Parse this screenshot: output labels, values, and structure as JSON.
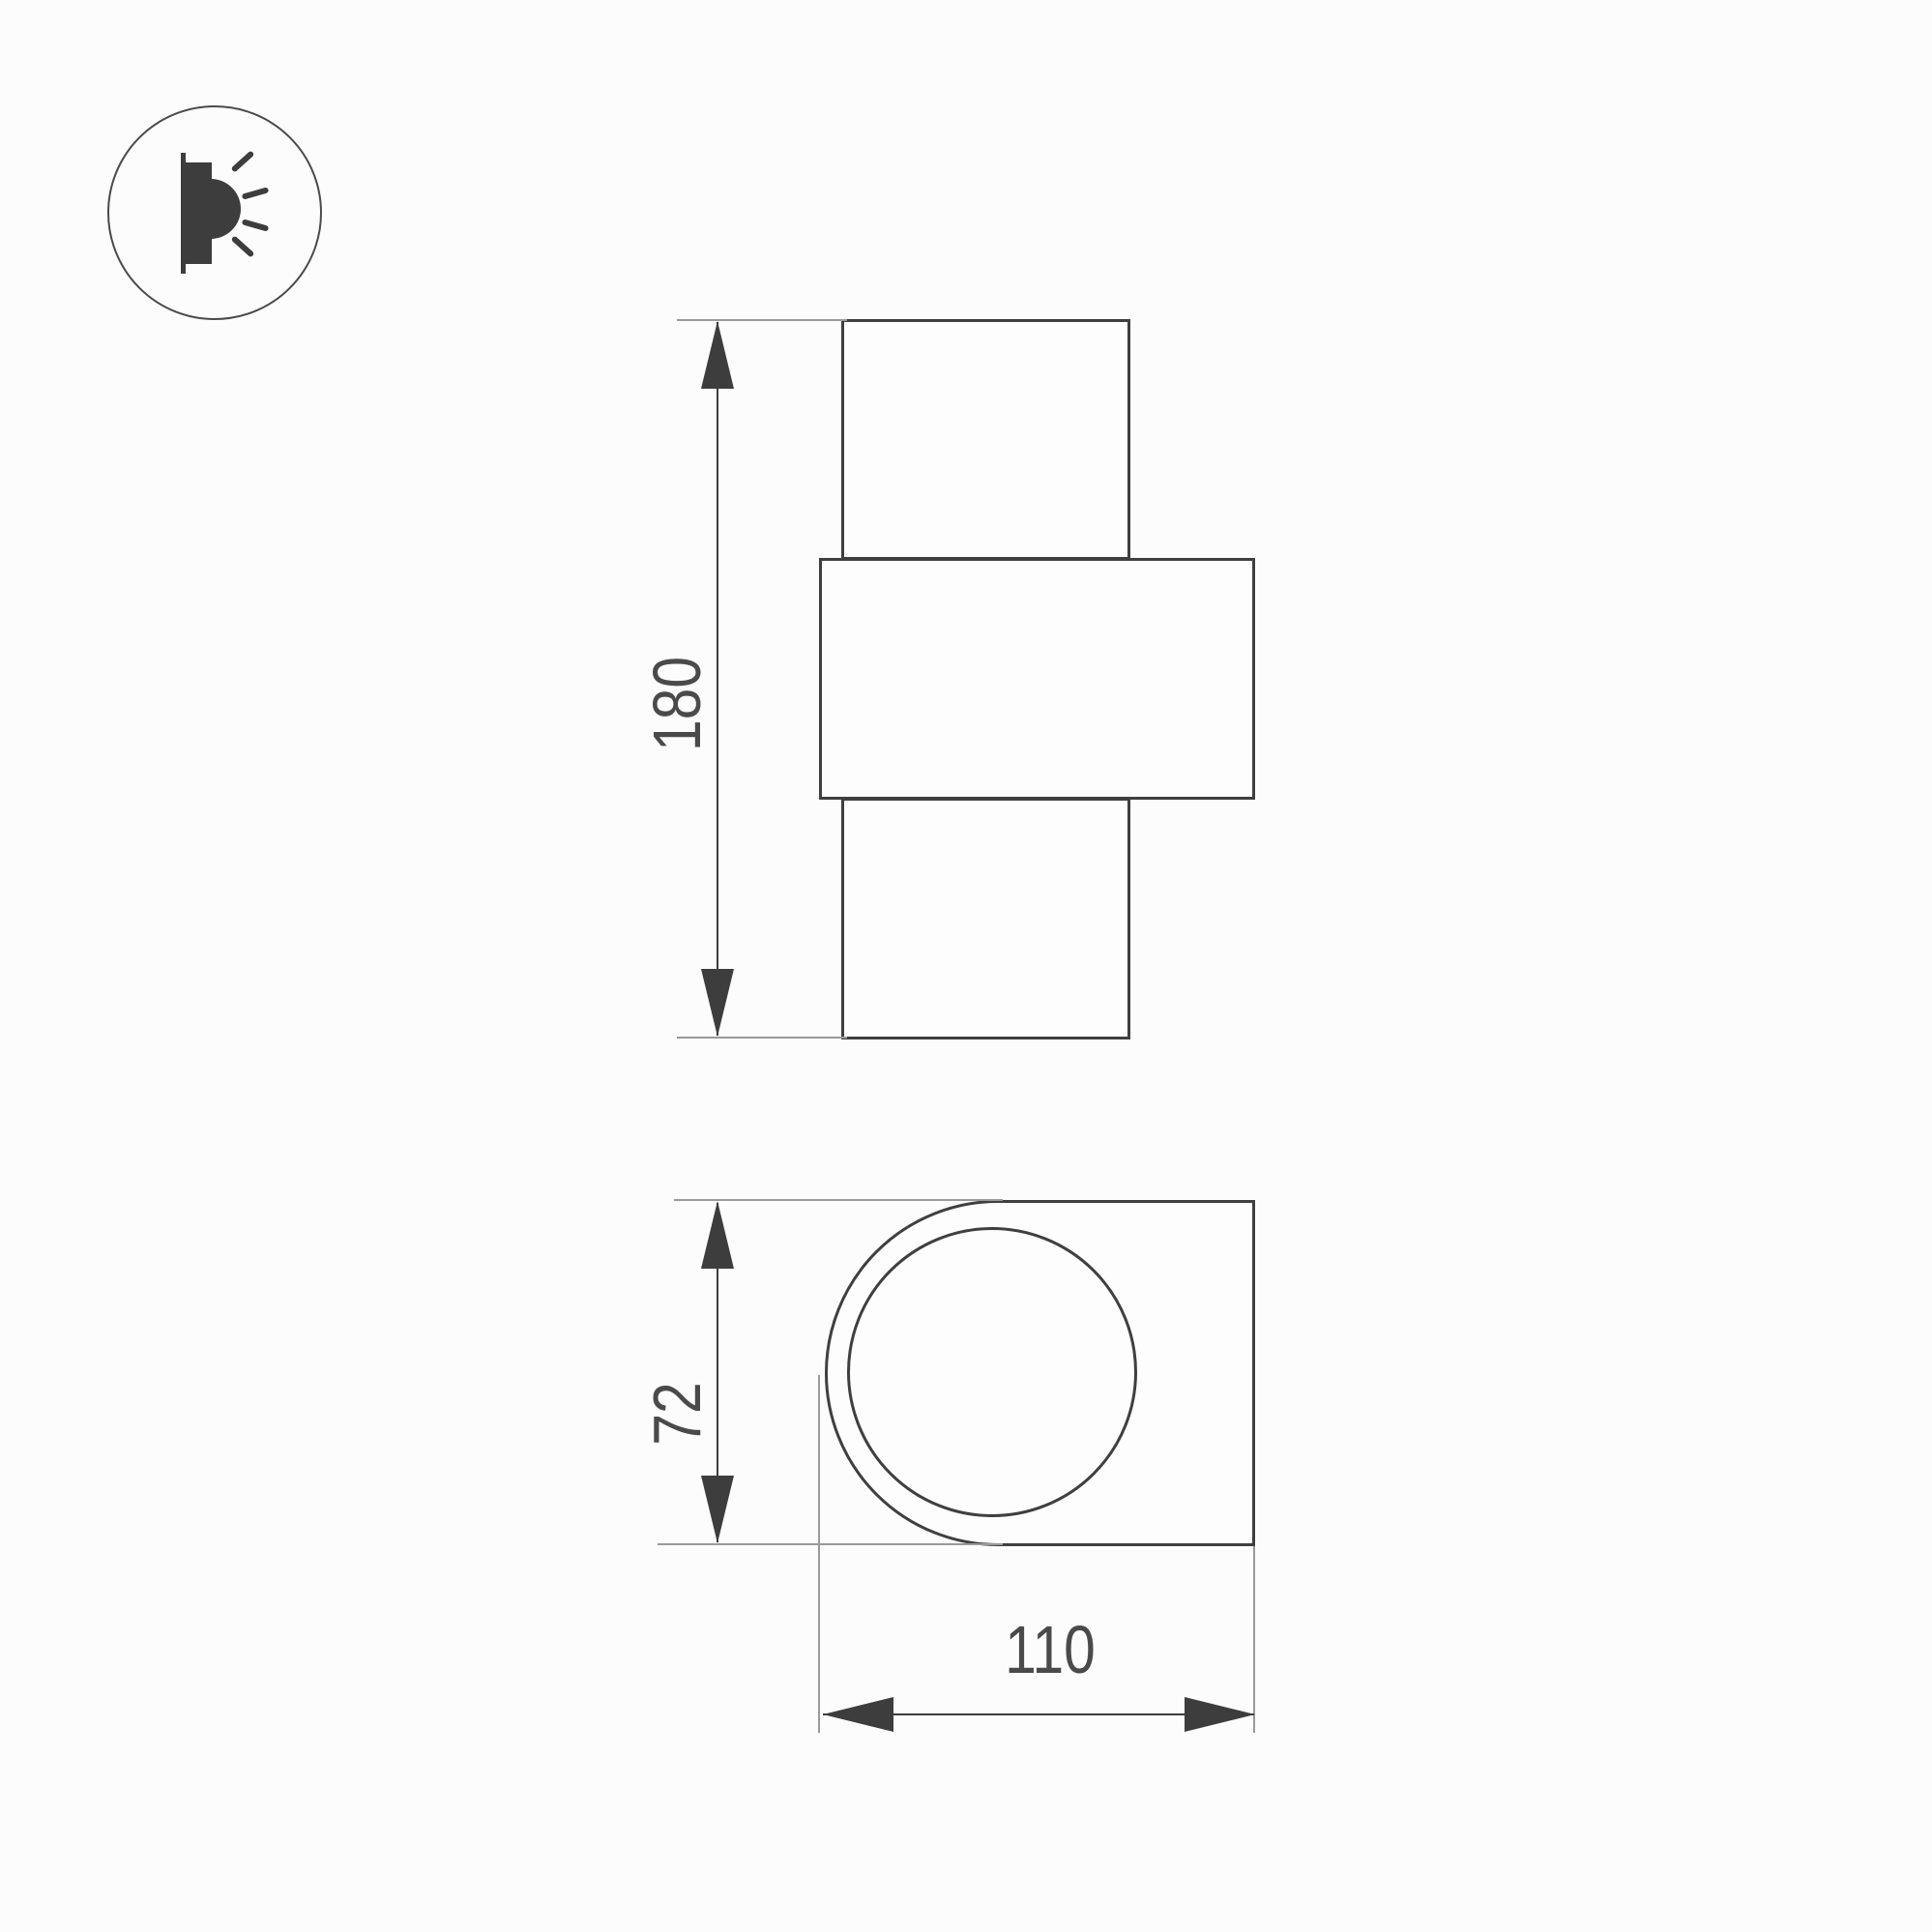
{
  "drawing": {
    "type": "technical-dimension-drawing",
    "icon": {
      "name": "wall-light-side-emission-icon"
    },
    "front_view": {
      "name": "front-view-wall-lamp",
      "height_dimension": {
        "value": "180",
        "orientation": "vertical"
      }
    },
    "top_view": {
      "name": "top-view-wall-lamp",
      "depth_dimension": {
        "value": "72",
        "orientation": "vertical"
      },
      "width_dimension": {
        "value": "110",
        "orientation": "horizontal"
      }
    }
  },
  "colors": {
    "background": "#fcfcfc",
    "outline": "#3f3f3f",
    "extension_line": "#9a9a9a",
    "dimension_line": "#3d3d3d",
    "text": "#4a4a4a"
  }
}
